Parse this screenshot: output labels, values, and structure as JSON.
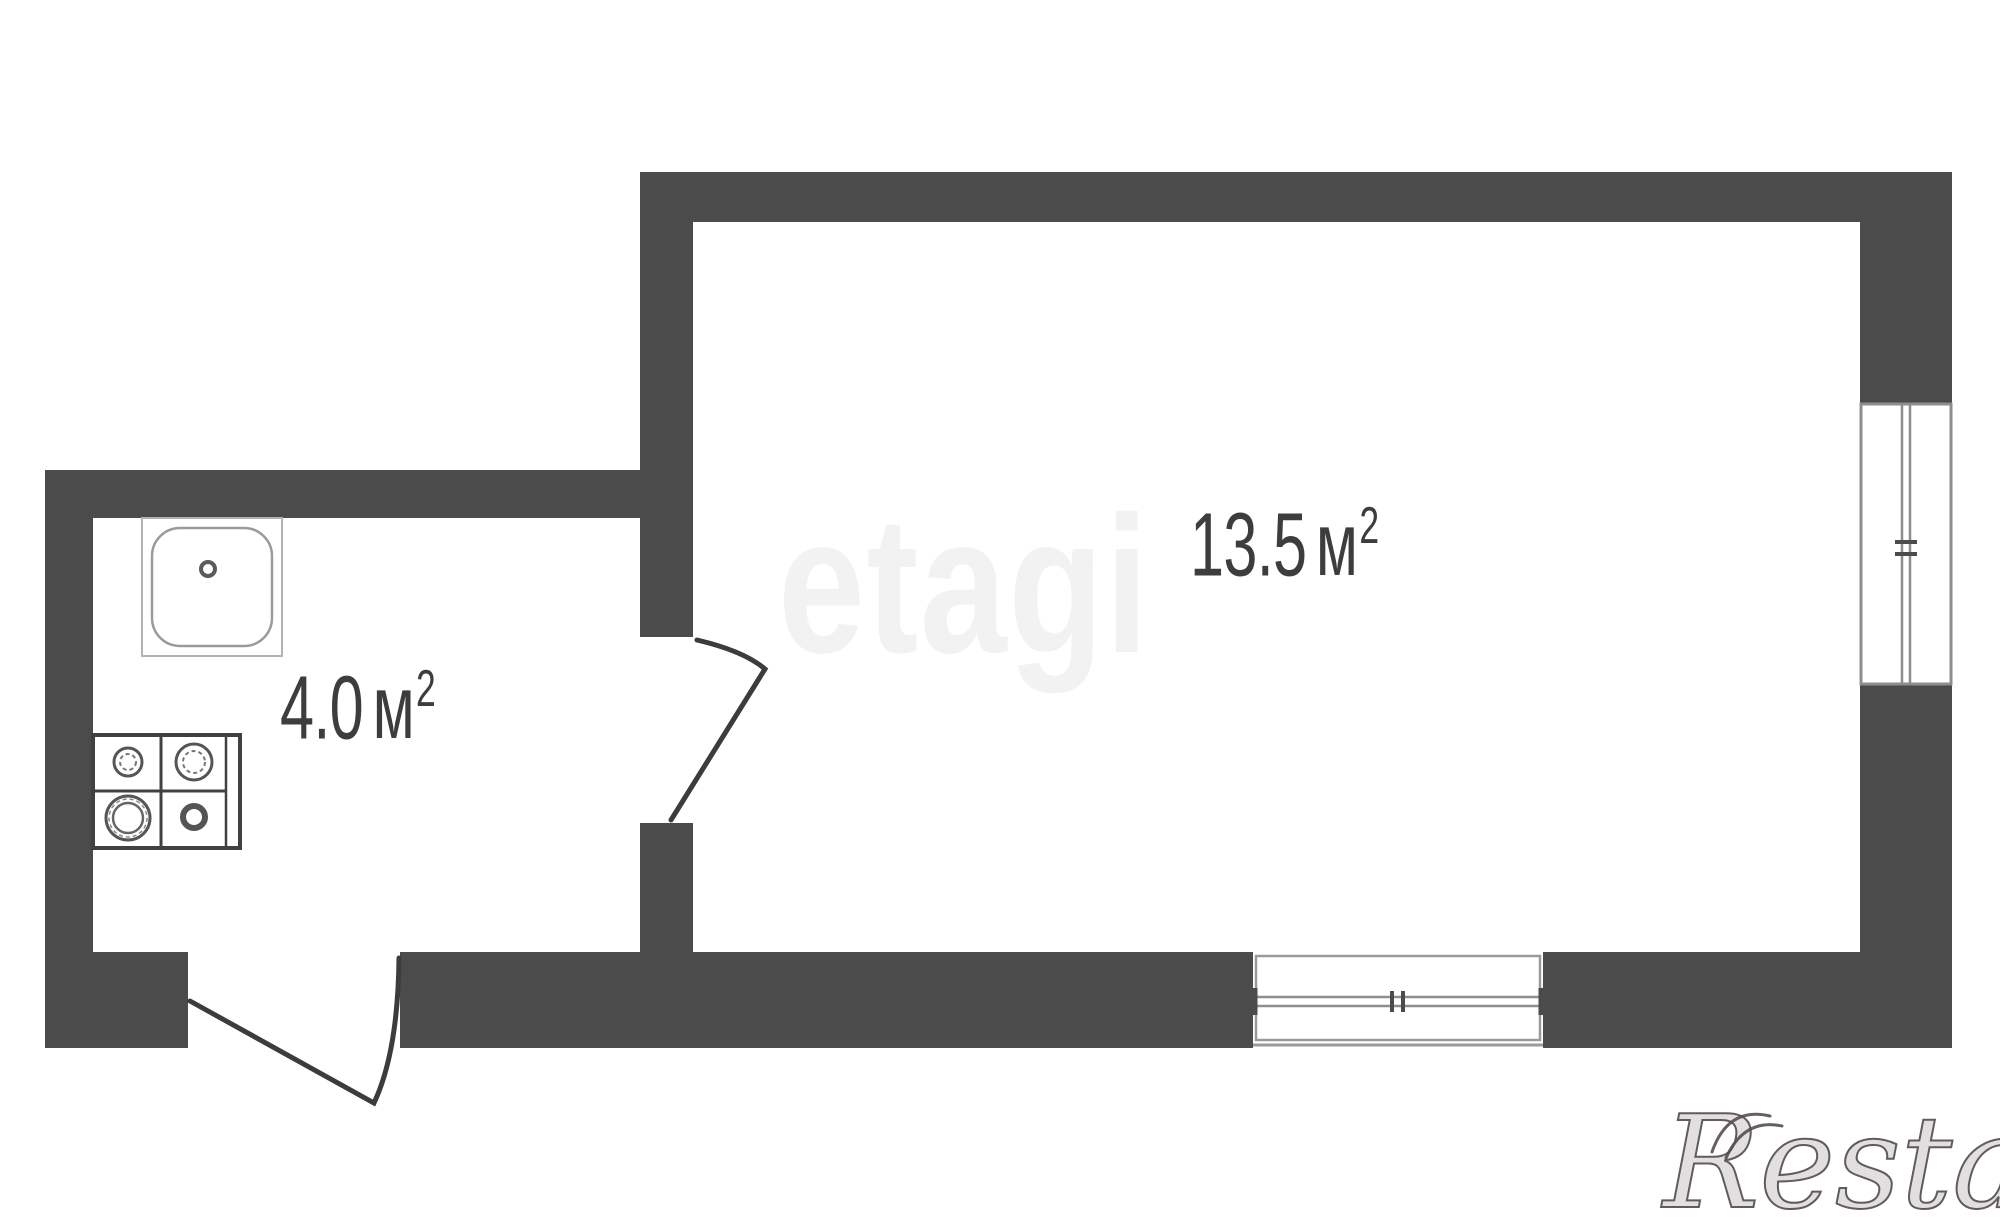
{
  "floorplan": {
    "rooms": [
      {
        "name": "living-room",
        "area": "13.5",
        "unit": "м",
        "sup": "2"
      },
      {
        "name": "kitchen",
        "area": "4.0",
        "unit": "м",
        "sup": "2"
      }
    ],
    "fixtures": [
      {
        "icon": "sink-icon",
        "room": "kitchen"
      },
      {
        "icon": "stove-icon",
        "room": "kitchen"
      }
    ],
    "openings": [
      {
        "type": "door",
        "between": "kitchen / living-room"
      },
      {
        "type": "door",
        "between": "kitchen / entry"
      },
      {
        "type": "window",
        "room": "living-room",
        "wall": "right"
      },
      {
        "type": "window",
        "room": "living-room",
        "wall": "bottom"
      }
    ],
    "colors": {
      "wall": "#4b4b4b",
      "label_text": "#3d3d3d",
      "background": "#ffffff",
      "fixture_line": "#8e8e8e",
      "door_line": "#3c3c3c"
    }
  },
  "watermarks": {
    "center": "etagi",
    "bottom_right": "Restate"
  }
}
